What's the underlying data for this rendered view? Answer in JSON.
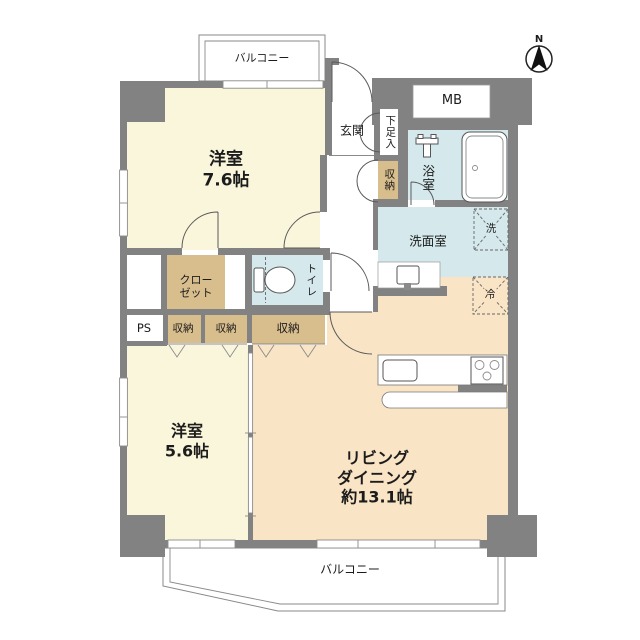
{
  "title": "マンション間取り図",
  "compass": {
    "north_label": "N"
  },
  "colors": {
    "wall": "#828282",
    "bedroom_floor": "#FAF6DC",
    "living_floor": "#F9E4C5",
    "storage_fill": "#D8BD8D",
    "wet_area_fill": "#D5E8EC",
    "background": "#ffffff"
  },
  "rooms": {
    "balcony_top": {
      "label": "バルコニー"
    },
    "balcony_bottom": {
      "label": "バルコニー"
    },
    "meter_box": {
      "label": "MB"
    },
    "entrance": {
      "label": "玄関"
    },
    "shoe_cupboard": {
      "label": "下足入"
    },
    "storage_entrance": {
      "label": "収納"
    },
    "bedroom1": {
      "name": "洋室",
      "size": "7.6帖"
    },
    "bathroom": {
      "label": "浴室"
    },
    "washroom": {
      "label": "洗面室"
    },
    "washer_space": {
      "label": "洗"
    },
    "fridge_space": {
      "label": "冷"
    },
    "closet": {
      "line1": "クロー",
      "line2": "ゼット"
    },
    "toilet": {
      "label": "トイレ"
    },
    "pipe_space": {
      "label": "PS"
    },
    "storage1": {
      "label": "収納"
    },
    "storage2": {
      "label": "収納"
    },
    "storage3": {
      "label": "収納"
    },
    "bedroom2": {
      "name": "洋室",
      "size": "5.6帖"
    },
    "living_dining": {
      "line1": "リビング",
      "line2": "ダイニング",
      "line3": "約13.1帖"
    }
  }
}
